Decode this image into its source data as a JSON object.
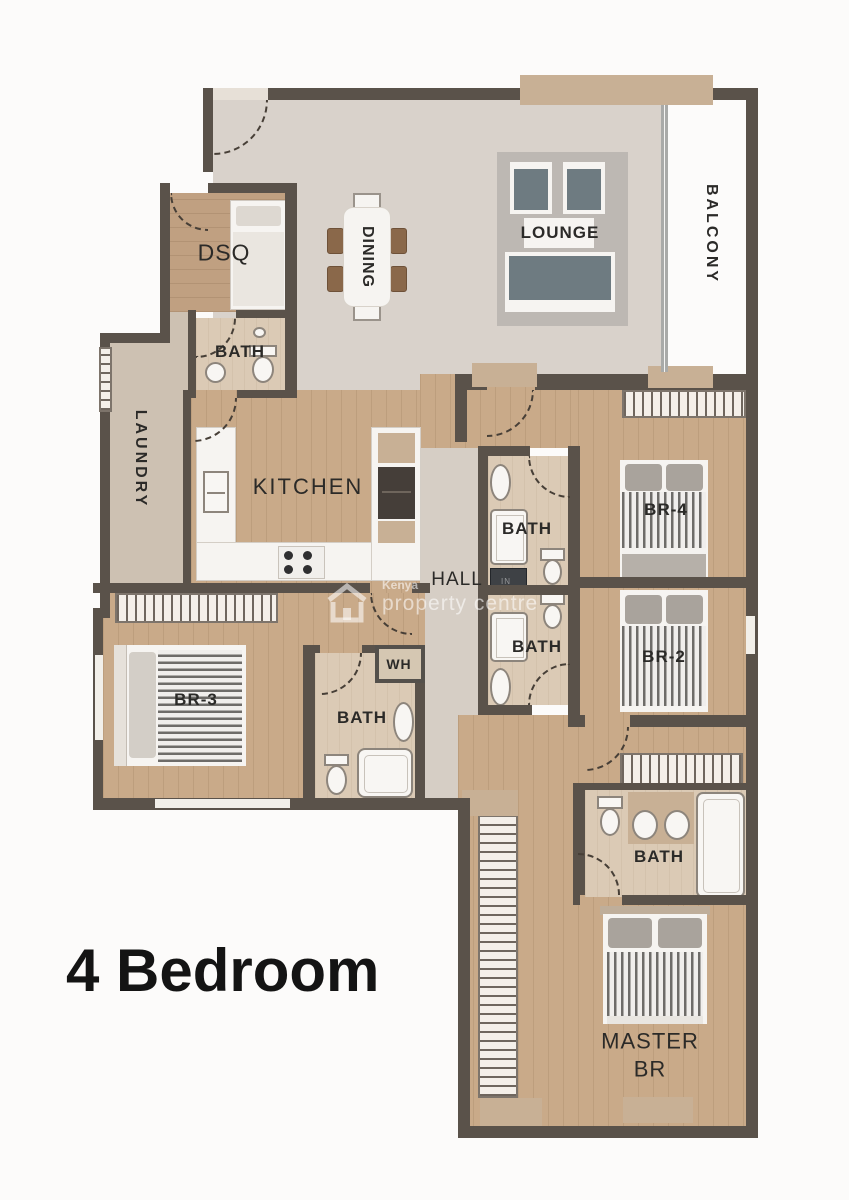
{
  "title": "4 Bedroom",
  "watermark": {
    "brand_top": "Kenya",
    "brand_bottom": "property centre"
  },
  "rooms": {
    "dsq": "DSQ",
    "dsq_bath": "BATH",
    "dining": "DINING",
    "lounge": "LOUNGE",
    "balcony": "BALCONY",
    "laundry": "LAUNDRY",
    "kitchen": "KITCHEN",
    "hall": "HALL",
    "bath_upper": "BATH",
    "bath_lower": "BATH",
    "water_heater": "WH",
    "br4": "BR-4",
    "br2": "BR-2",
    "br3": "BR-3",
    "br3_bath": "BATH",
    "master_bath": "BATH",
    "master_line1": "MASTER",
    "master_line2": "BR"
  },
  "appliances": {
    "washer": "IN"
  },
  "colors": {
    "wall": "#5a524a",
    "wood_floor": "#c9aa89",
    "gray_floor": "#d9d2cb",
    "balcony_floor": "#ede3d2",
    "tan_accent": "#c8b095",
    "duvet_stripe": "#6e6c69",
    "lounge_seat": "#6e7b81",
    "title_text": "#141414"
  }
}
